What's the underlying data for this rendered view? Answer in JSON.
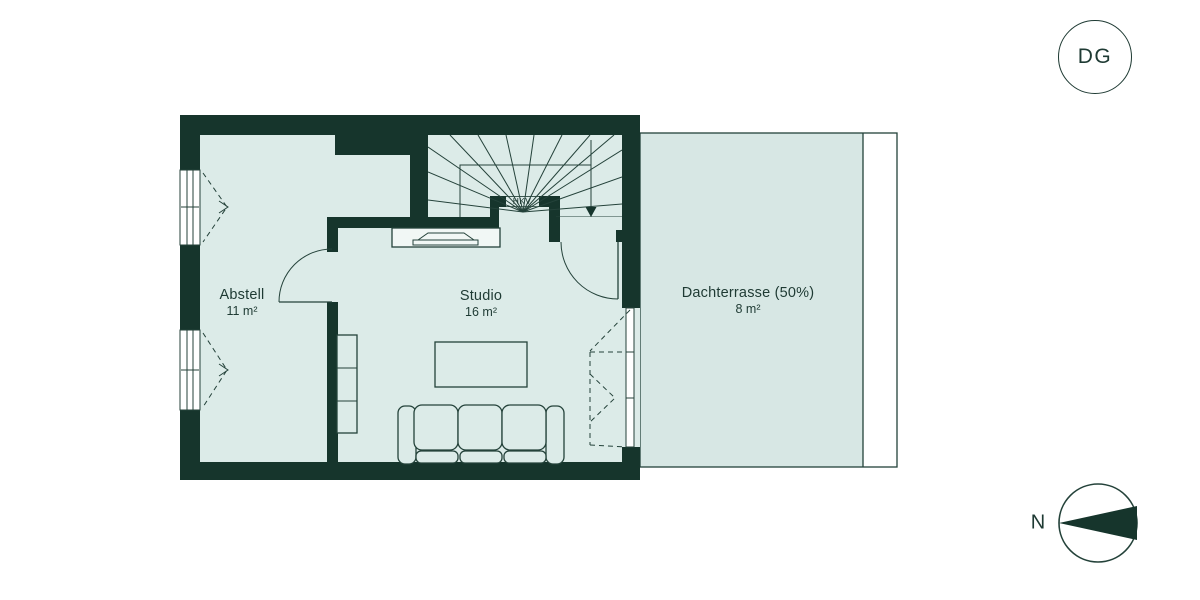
{
  "colors": {
    "paper": "#ffffff",
    "wall": "#16352c",
    "floor": "#dcebe8",
    "terrace": "#d7e7e4",
    "line": "#24423a",
    "text": "#1e3a33"
  },
  "floor_badge": {
    "label": "DG"
  },
  "compass": {
    "label": "N"
  },
  "rooms": [
    {
      "name": "Abstell",
      "area": "11 m²"
    },
    {
      "name": "Studio",
      "area": "16 m²"
    },
    {
      "name": "Dachterrasse (50%)",
      "area": "8 m²"
    }
  ],
  "labels": {
    "hkv": "HKV"
  }
}
